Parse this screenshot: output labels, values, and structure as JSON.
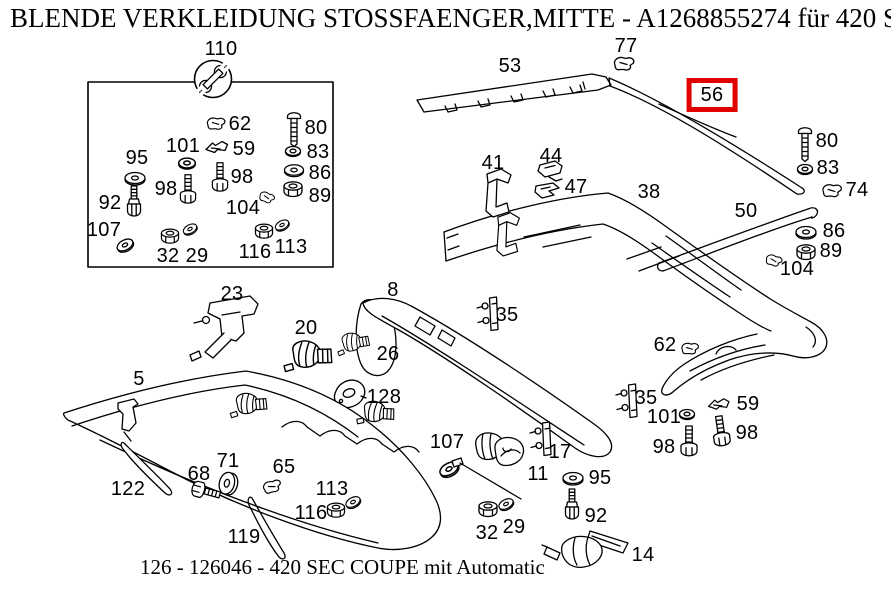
{
  "header": {
    "title": "BLENDE VERKLEIDUNG STOSSFAENGER,MITTE - A1268855274 für 420 SEC"
  },
  "footer": {
    "caption": "126 - 126046 - 420 SEC COUPE mit Automatic"
  },
  "colors": {
    "highlight_box": "#e10000",
    "line": "#000000",
    "background": "#ffffff"
  },
  "selected_part": {
    "number": "56"
  },
  "hardware_box": {
    "tool_icon": "wrench-icon",
    "label": "110"
  },
  "diagram": {
    "callouts": [
      {
        "id": "110",
        "label": "110",
        "x": 221,
        "y": 49
      },
      {
        "id": "62-a",
        "label": "62",
        "x": 240,
        "y": 124
      },
      {
        "id": "80-a",
        "label": "80",
        "x": 316,
        "y": 128
      },
      {
        "id": "101-a",
        "label": "101",
        "x": 183,
        "y": 146
      },
      {
        "id": "59-a",
        "label": "59",
        "x": 244,
        "y": 149
      },
      {
        "id": "83-a",
        "label": "83",
        "x": 318,
        "y": 152
      },
      {
        "id": "95-a",
        "label": "95",
        "x": 137,
        "y": 158
      },
      {
        "id": "86-a",
        "label": "86",
        "x": 320,
        "y": 173
      },
      {
        "id": "98-a1",
        "label": "98",
        "x": 166,
        "y": 189
      },
      {
        "id": "98-a2",
        "label": "98",
        "x": 242,
        "y": 177
      },
      {
        "id": "89-a",
        "label": "89",
        "x": 320,
        "y": 196
      },
      {
        "id": "92-a",
        "label": "92",
        "x": 110,
        "y": 203
      },
      {
        "id": "104-a",
        "label": "104",
        "x": 243,
        "y": 208
      },
      {
        "id": "107-a",
        "label": "107",
        "x": 104,
        "y": 230
      },
      {
        "id": "32-a",
        "label": "32",
        "x": 168,
        "y": 256
      },
      {
        "id": "29-a",
        "label": "29",
        "x": 197,
        "y": 256
      },
      {
        "id": "116-a",
        "label": "116",
        "x": 255,
        "y": 252
      },
      {
        "id": "113-a",
        "label": "113",
        "x": 291,
        "y": 247
      },
      {
        "id": "53",
        "label": "53",
        "x": 510,
        "y": 66
      },
      {
        "id": "77",
        "label": "77",
        "x": 626,
        "y": 46
      },
      {
        "id": "56",
        "label": "56",
        "x": 712,
        "y": 95,
        "selected": true
      },
      {
        "id": "80-b",
        "label": "80",
        "x": 827,
        "y": 141
      },
      {
        "id": "83-b",
        "label": "83",
        "x": 828,
        "y": 168
      },
      {
        "id": "74",
        "label": "74",
        "x": 857,
        "y": 190
      },
      {
        "id": "41",
        "label": "41",
        "x": 493,
        "y": 163
      },
      {
        "id": "44",
        "label": "44",
        "x": 551,
        "y": 156
      },
      {
        "id": "47",
        "label": "47",
        "x": 576,
        "y": 187
      },
      {
        "id": "38",
        "label": "38",
        "x": 649,
        "y": 192
      },
      {
        "id": "50",
        "label": "50",
        "x": 746,
        "y": 211
      },
      {
        "id": "86-b",
        "label": "86",
        "x": 834,
        "y": 231
      },
      {
        "id": "89-b",
        "label": "89",
        "x": 831,
        "y": 251
      },
      {
        "id": "104-b",
        "label": "104",
        "x": 797,
        "y": 269
      },
      {
        "id": "23",
        "label": "23",
        "x": 232,
        "y": 294
      },
      {
        "id": "8",
        "label": "8",
        "x": 393,
        "y": 290
      },
      {
        "id": "20",
        "label": "20",
        "x": 306,
        "y": 328
      },
      {
        "id": "35-a",
        "label": "35",
        "x": 507,
        "y": 315
      },
      {
        "id": "26",
        "label": "26",
        "x": 388,
        "y": 354
      },
      {
        "id": "62-b",
        "label": "62",
        "x": 665,
        "y": 345
      },
      {
        "id": "5",
        "label": "5",
        "x": 139,
        "y": 379
      },
      {
        "id": "128",
        "label": "128",
        "x": 384,
        "y": 397
      },
      {
        "id": "35-b",
        "label": "35",
        "x": 646,
        "y": 398
      },
      {
        "id": "59-b",
        "label": "59",
        "x": 748,
        "y": 404
      },
      {
        "id": "101-b",
        "label": "101",
        "x": 664,
        "y": 417
      },
      {
        "id": "98-b2",
        "label": "98",
        "x": 747,
        "y": 433
      },
      {
        "id": "98-b1",
        "label": "98",
        "x": 664,
        "y": 447
      },
      {
        "id": "107-b",
        "label": "107",
        "x": 447,
        "y": 442
      },
      {
        "id": "17",
        "label": "17",
        "x": 560,
        "y": 452
      },
      {
        "id": "71",
        "label": "71",
        "x": 228,
        "y": 461
      },
      {
        "id": "65",
        "label": "65",
        "x": 284,
        "y": 467
      },
      {
        "id": "11",
        "label": "11",
        "x": 538,
        "y": 474
      },
      {
        "id": "68",
        "label": "68",
        "x": 199,
        "y": 474
      },
      {
        "id": "95-b",
        "label": "95",
        "x": 600,
        "y": 478
      },
      {
        "id": "122",
        "label": "122",
        "x": 128,
        "y": 489
      },
      {
        "id": "113-b",
        "label": "113",
        "x": 332,
        "y": 489
      },
      {
        "id": "116-b",
        "label": "116",
        "x": 311,
        "y": 513
      },
      {
        "id": "92-b",
        "label": "92",
        "x": 596,
        "y": 516
      },
      {
        "id": "29-b",
        "label": "29",
        "x": 514,
        "y": 527
      },
      {
        "id": "32-b",
        "label": "32",
        "x": 487,
        "y": 533
      },
      {
        "id": "119",
        "label": "119",
        "x": 244,
        "y": 537
      },
      {
        "id": "14",
        "label": "14",
        "x": 643,
        "y": 555
      }
    ]
  }
}
